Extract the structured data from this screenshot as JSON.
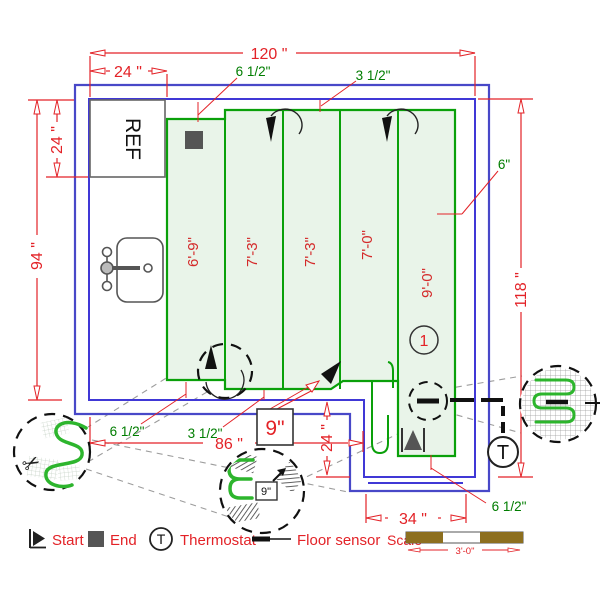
{
  "labels": {
    "ref": "REF",
    "zone_number": "1",
    "spacing_box": "9\"",
    "detail_spacing": "9\"",
    "thermostat_symbol": "T",
    "legend_thermostat_symbol": "T"
  },
  "dimensions": {
    "overall_width": "120 \"",
    "ref_width": "24 \"",
    "ref_depth": "24 \"",
    "left_height": "94 \"",
    "right_height": "118 \"",
    "lower_width": "86 \"",
    "step_depth": "24 \"",
    "opening_width": "34 \""
  },
  "clearances": {
    "top_left": "6 1/2\"",
    "top_right": "3 1/2\"",
    "right": "6\"",
    "bottom_left": "6 1/2\"",
    "bottom_center": "3 1/2\"",
    "bottom_right": "6 1/2\""
  },
  "mat_strips": [
    "6'-9\"",
    "7'-3\"",
    "7'-3\"",
    "7'-0\"",
    "9'-0\""
  ],
  "legend": {
    "start": "Start",
    "end": "End",
    "thermostat": "Thermostat",
    "floor_sensor": "Floor sensor",
    "scale": "Scale",
    "scale_length": "3'-0\""
  },
  "colors": {
    "dimension_red": "#e32227",
    "label_green": "#007d00",
    "mat_border_green": "#0aa00a",
    "mat_fill": "#e9f4e9",
    "wall_outer_blue": "#4848c8",
    "wall_inner_blue": "#4038d6",
    "scale_bar_brown": "#8d6f1f"
  }
}
